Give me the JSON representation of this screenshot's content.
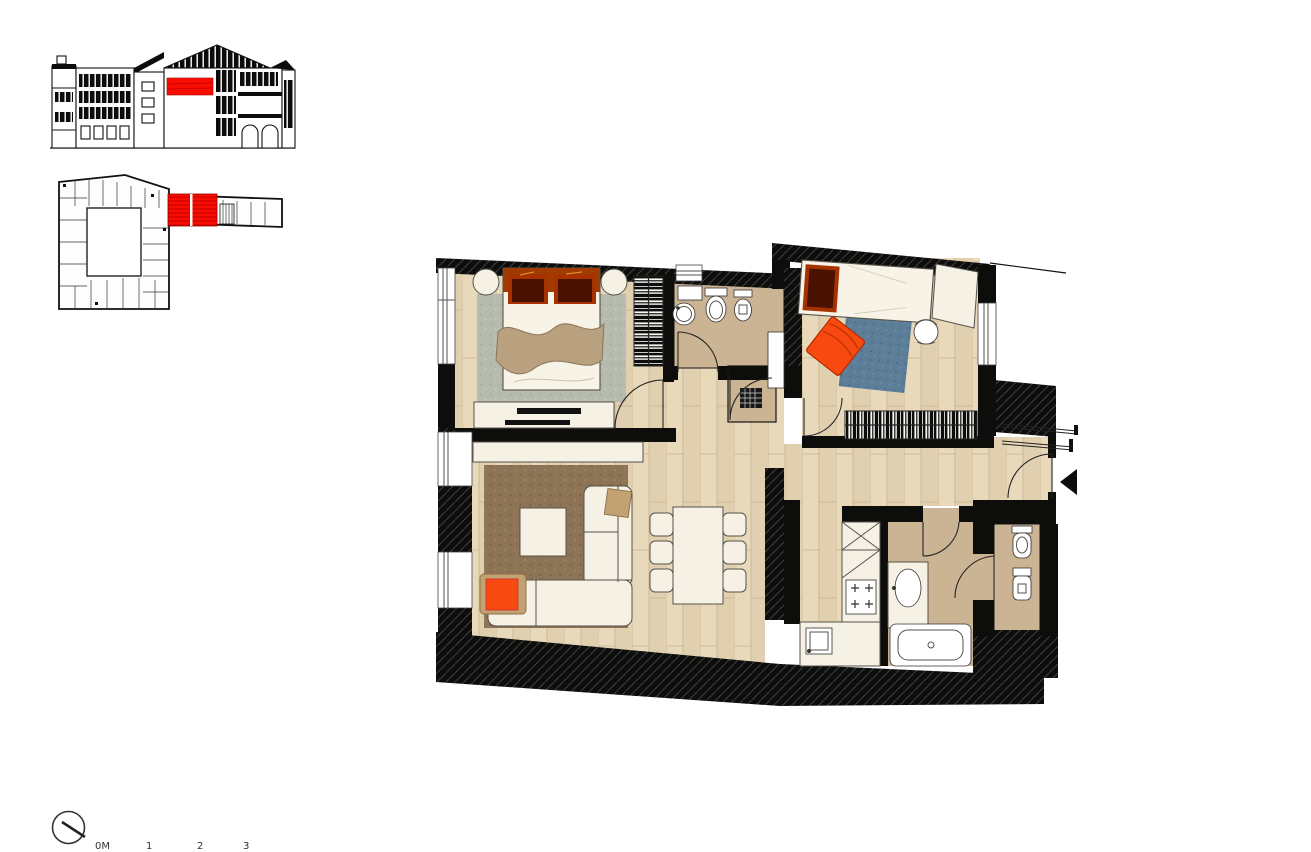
{
  "canvas": {
    "width": 1311,
    "height": 849,
    "background": "#ffffff"
  },
  "colors": {
    "wall": "#0d0d0c",
    "red": "#f90d00",
    "redline": "#c90000",
    "tile": "#cbb493",
    "rug_gray": "#b7bbae",
    "rug_brown": "#8d7456",
    "rug_blue": "#5d7e99",
    "furniture_white": "#f5f1e4",
    "orange": "#f84a10",
    "maroon": "#4a1202",
    "pillow_edge": "#a63200",
    "headboard": "#a03c02",
    "blanket": "#b9a07f",
    "cushion_tan": "#c2a172",
    "wood_a": "#e8d9bb",
    "wood_b": "#e1d0b0",
    "wood_line": "#c9b28d"
  },
  "section": {
    "name": "building-cross-section",
    "highlight": "apartment-location-highlight"
  },
  "keyplan": {
    "name": "floor-key-plan",
    "highlight": "apartment-unit-highlight"
  },
  "floorplan": {
    "name": "apartment-floor-plan",
    "rooms": [
      "bedroom-1",
      "bathroom-1",
      "closet",
      "bedroom-2",
      "living-room",
      "dining-area",
      "hallway",
      "kitchen",
      "bathroom-2",
      "wc",
      "entrance-hall"
    ]
  },
  "compass": {
    "name": "north-indicator"
  },
  "scalebar": {
    "labels": [
      "0M",
      "1",
      "2",
      "3"
    ]
  }
}
